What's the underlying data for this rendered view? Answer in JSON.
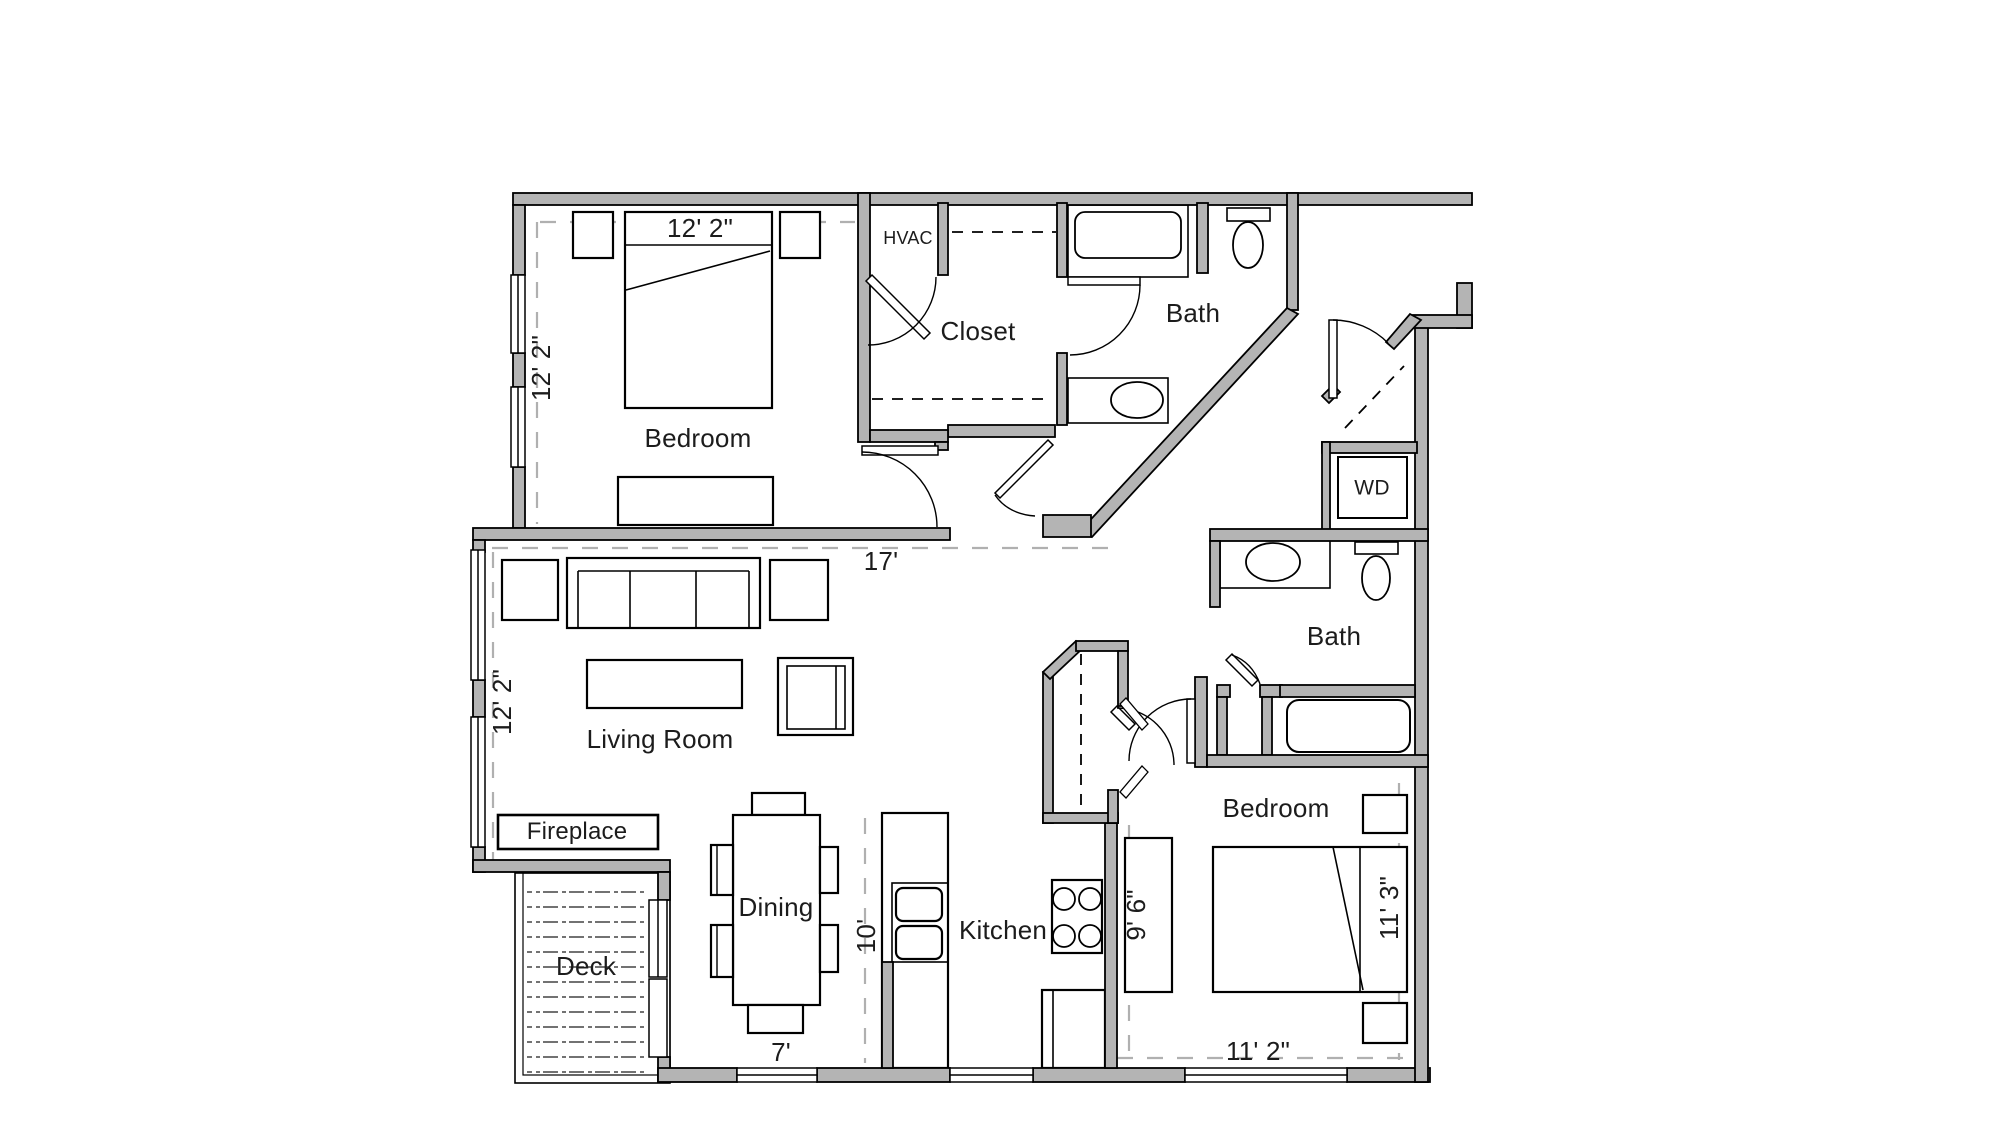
{
  "labels": {
    "bedroom1": "Bedroom",
    "bedroom2": "Bedroom",
    "closet": "Closet",
    "hvac": "HVAC",
    "bath_top": "Bath",
    "bath_right": "Bath",
    "wd": "WD",
    "living_room": "Living Room",
    "dining": "Dining",
    "kitchen": "Kitchen",
    "deck": "Deck",
    "fireplace": "Fireplace"
  },
  "dimensions": {
    "bedroom1_width": "12' 2\"",
    "bedroom1_depth": "12' 2\"",
    "living_width": "17'",
    "living_depth": "12' 2\"",
    "dining_width": "7'",
    "dining_depth": "10'",
    "kitchen_depth": "9' 6\"",
    "bedroom2_width": "11' 2\"",
    "bedroom2_depth": "11' 3\""
  },
  "colors": {
    "wall_fill": "#b4b4b4",
    "line": "#000000",
    "dimension_line": "#b0b0b0",
    "background": "#ffffff"
  }
}
